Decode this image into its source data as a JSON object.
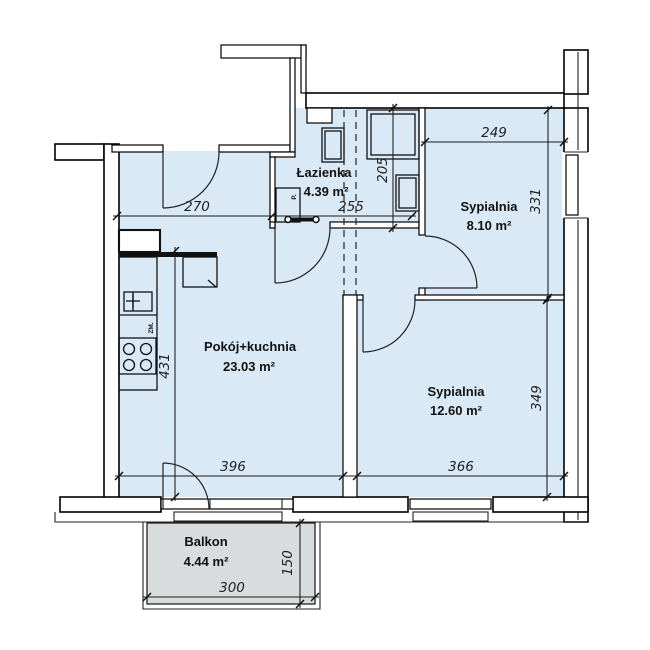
{
  "colors": {
    "room_fill": "#d9eaf6",
    "balcony_fill": "#d9dcdc",
    "wall_line": "#000000",
    "dim_line": "#1a1a1a"
  },
  "rooms": [
    {
      "key": "lazienka",
      "name": "Łazienka",
      "area_label": "4.39 m²",
      "area_m2": 4.39
    },
    {
      "key": "sypialnia_1",
      "name": "Sypialnia",
      "area_label": "8.10 m²",
      "area_m2": 8.1
    },
    {
      "key": "pokoj_kuchnia",
      "name": "Pokój+kuchnia",
      "area_label": "23.03 m²",
      "area_m2": 23.03
    },
    {
      "key": "sypialnia_2",
      "name": "Sypialnia",
      "area_label": "12.60 m²",
      "area_m2": 12.6
    },
    {
      "key": "balkon",
      "name": "Balkon",
      "area_label": "4.44 m²",
      "area_m2": 4.44
    }
  ],
  "dimensions": [
    {
      "label": "270",
      "cm": 270,
      "orientation": "horizontal",
      "measures": "pokoj_kuchnia top width"
    },
    {
      "label": "255",
      "cm": 255,
      "orientation": "horizontal",
      "measures": "lazienka width"
    },
    {
      "label": "205",
      "cm": 205,
      "orientation": "vertical",
      "measures": "lazienka depth"
    },
    {
      "label": "249",
      "cm": 249,
      "orientation": "horizontal",
      "measures": "sypialnia_1 width"
    },
    {
      "label": "331",
      "cm": 331,
      "orientation": "vertical",
      "measures": "sypialnia_1 depth"
    },
    {
      "label": "431",
      "cm": 431,
      "orientation": "vertical",
      "measures": "pokoj_kuchnia depth"
    },
    {
      "label": "396",
      "cm": 396,
      "orientation": "horizontal",
      "measures": "pokoj_kuchnia bottom width"
    },
    {
      "label": "366",
      "cm": 366,
      "orientation": "horizontal",
      "measures": "sypialnia_2 width"
    },
    {
      "label": "349",
      "cm": 349,
      "orientation": "vertical",
      "measures": "sypialnia_2 depth"
    },
    {
      "label": "300",
      "cm": 300,
      "orientation": "horizontal",
      "measures": "balkon width"
    },
    {
      "label": "150",
      "cm": 150,
      "orientation": "vertical",
      "measures": "balkon depth"
    }
  ],
  "annotations": {
    "dishwasher": "ZM.",
    "washer": "P."
  },
  "fixtures": [
    "kitchen-counter",
    "kitchen-sink",
    "stove",
    "fridge",
    "dishwasher",
    "shower",
    "washing-machine",
    "bathroom-sink",
    "radiator"
  ]
}
